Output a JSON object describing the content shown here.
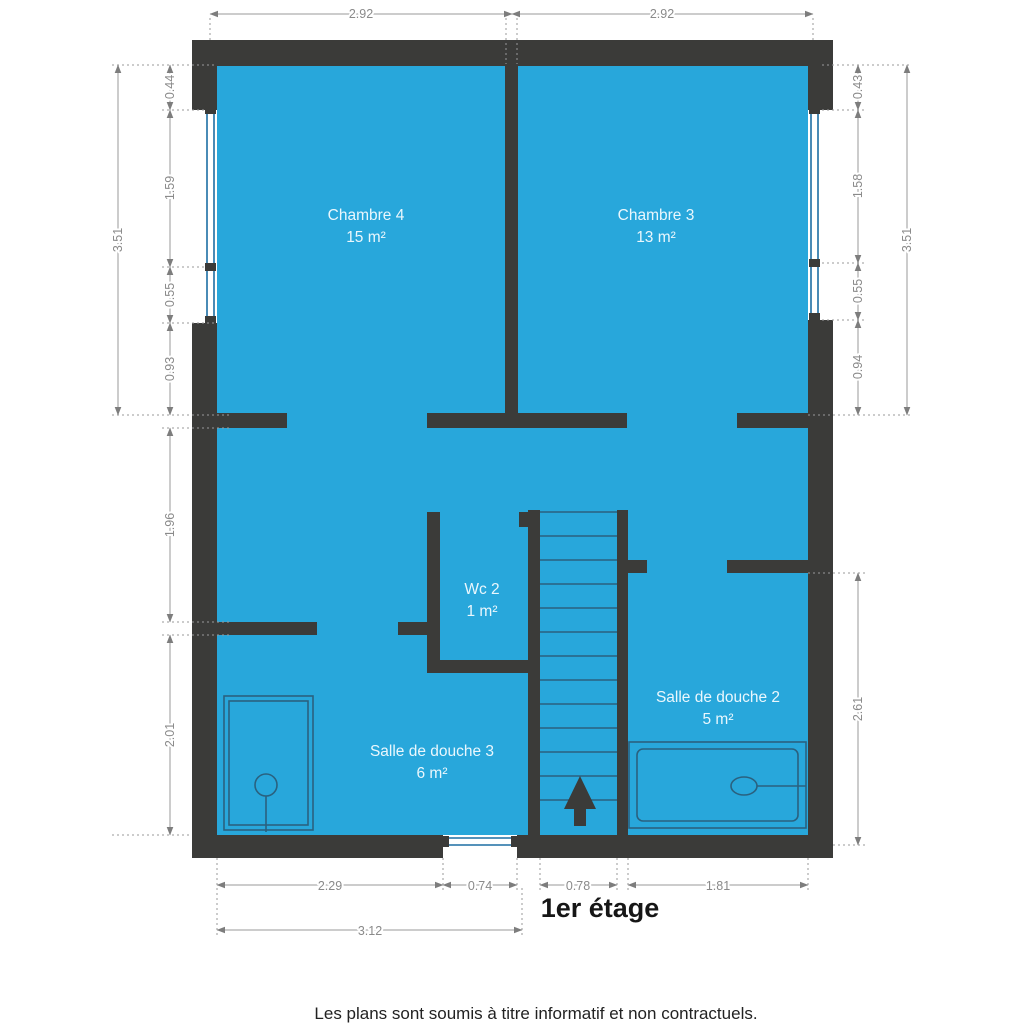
{
  "title": {
    "floor": "1er étage"
  },
  "footer": {
    "disclaimer": "Les plans sont soumis à titre informatif et non contractuels."
  },
  "rooms": {
    "chambre4": {
      "name": "Chambre 4",
      "area": "15 m²"
    },
    "chambre3": {
      "name": "Chambre 3",
      "area": "13 m²"
    },
    "wc2": {
      "name": "Wc 2",
      "area": "1 m²"
    },
    "salle_de_douche_3": {
      "name": "Salle de douche 3",
      "area": "6 m²"
    },
    "salle_de_douche_2": {
      "name": "Salle de douche 2",
      "area": "5 m²"
    }
  },
  "dimensions": {
    "top": [
      "2.92",
      "2.92"
    ],
    "left_outer": "3.51",
    "left_inner": [
      "0.44",
      "1.59",
      "0.55",
      "0.93",
      "1.96",
      "2.01"
    ],
    "right_outer": "3.51",
    "right_inner": [
      "0.43",
      "1.58",
      "0.55",
      "0.94",
      "2.61"
    ],
    "bottom": [
      "2.29",
      "0.74",
      "0.78",
      "1.81"
    ],
    "bottom_total": "3.12"
  },
  "icons": {
    "stairs_direction": "up-arrow"
  },
  "colors": {
    "floor": "#28a7db",
    "wall": "#3b3b39",
    "window": "#1d6ea3",
    "fixture": "#2a617f",
    "dim-line": "#9a9a9a",
    "dim-text": "#8a8a8a",
    "room-text": "#eaf7fd",
    "text-dark": "#161616"
  }
}
